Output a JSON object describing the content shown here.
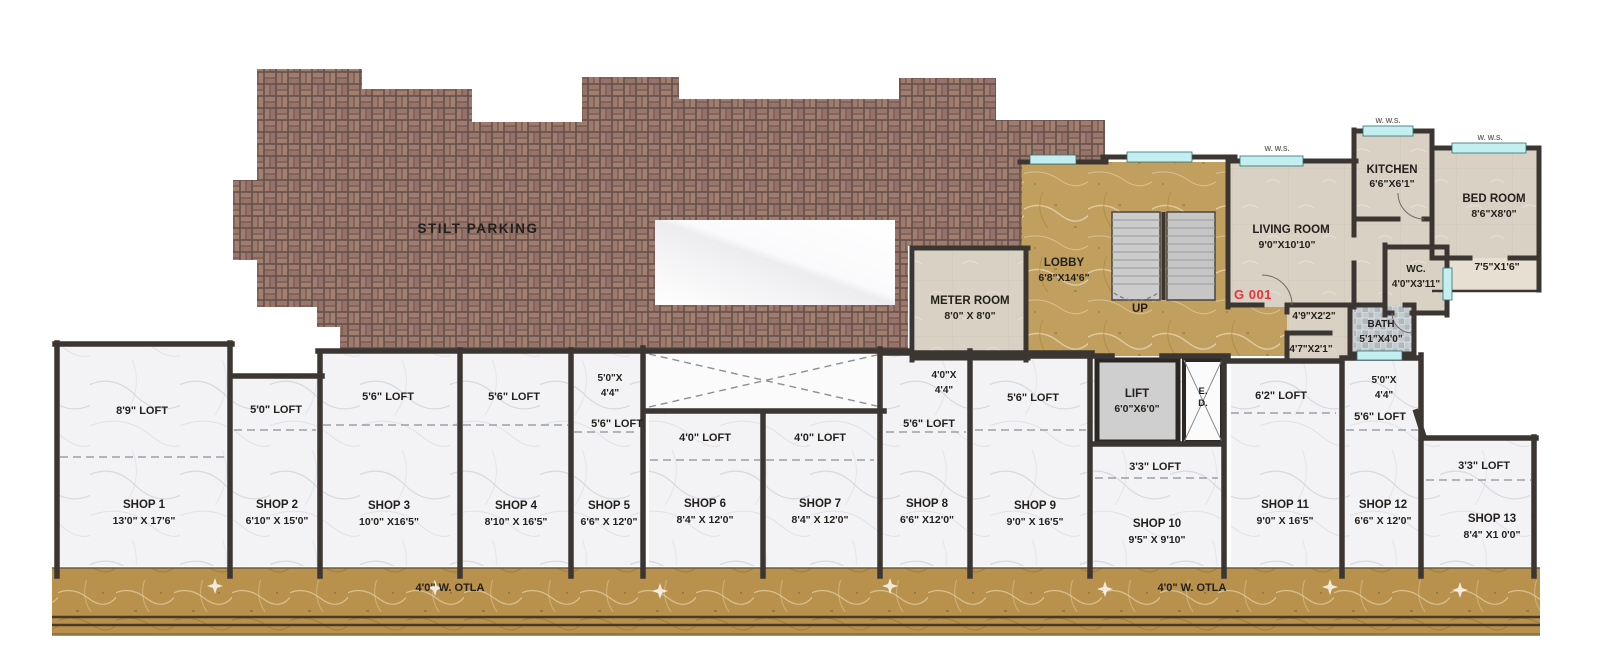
{
  "parking": {
    "label": "STILT PARKING"
  },
  "meter_room": {
    "name": "METER ROOM",
    "size": "8'0\" X 8'0\""
  },
  "lobby": {
    "name": "LOBBY",
    "size": "6'8\"X14'6\""
  },
  "staircase": {
    "up_label": "UP"
  },
  "flat": {
    "number": "G 001",
    "living_room": {
      "name": "LIVING ROOM",
      "size": "9'0\"X10'10\""
    },
    "kitchen": {
      "name": "KITCHEN",
      "size": "6'6\"X6'1\""
    },
    "bed_room": {
      "name": "BED ROOM",
      "size": "8'6\"X8'0\""
    },
    "balcony_size": "7'5\"X1'6\"",
    "wc": {
      "name": "WC.",
      "size": "4'0\"X3'11\""
    },
    "bath": {
      "name": "BATH",
      "size": "5'1\"X4'0\""
    },
    "passage_1": "4'9\"X2'2\"",
    "passage_2": "4'7\"X2'1\"",
    "window_note": "W. W.S."
  },
  "lift": {
    "name": "LIFT",
    "size": "6'0\"X6'0\""
  },
  "duct": {
    "line1": "E.",
    "line2": "D."
  },
  "shops": [
    {
      "name": "SHOP 1",
      "size": "13'0\" X 17'6\"",
      "loft": "8'9\" LOFT"
    },
    {
      "name": "SHOP 2",
      "size": "6'10\" X 15'0\"",
      "loft": "5'0\" LOFT"
    },
    {
      "name": "SHOP 3",
      "size": "10'0\" X16'5\"",
      "loft": "5'6\" LOFT"
    },
    {
      "name": "SHOP 4",
      "size": "8'10\" X 16'5\"",
      "loft": "5'6\" LOFT"
    },
    {
      "name": "SHOP 5",
      "size": "6'6\" X 12'0\"",
      "loft": "5'6\" LOFT",
      "niche_l1": "5'0\"X",
      "niche_l2": "4'4\""
    },
    {
      "name": "SHOP 6",
      "size": "8'4\" X 12'0\"",
      "loft": "4'0\" LOFT"
    },
    {
      "name": "SHOP 7",
      "size": "8'4\" X 12'0\"",
      "loft": "4'0\" LOFT"
    },
    {
      "name": "SHOP 8",
      "size": "6'6\" X12'0\"",
      "loft": "5'6\" LOFT",
      "niche_l1": "4'0\"X",
      "niche_l2": "4'4\""
    },
    {
      "name": "SHOP 9",
      "size": "9'0\" X 16'5\"",
      "loft": "5'6\" LOFT"
    },
    {
      "name": "SHOP 10",
      "size": "9'5\" X 9'10\"",
      "loft": "3'3\" LOFT"
    },
    {
      "name": "SHOP 11",
      "size": "9'0\" X 16'5\"",
      "loft": "6'2\" LOFT"
    },
    {
      "name": "SHOP 12",
      "size": "6'6\" X 12'0\"",
      "loft": "5'6\" LOFT",
      "niche_l1": "5'0\"X",
      "niche_l2": "4'4\""
    },
    {
      "name": "SHOP 13",
      "size": "8'4\" X1 0'0\"",
      "loft": "3'3\" LOFT"
    }
  ],
  "otla": {
    "left_label": "4'0\" W. OTLA",
    "right_label": "4'0\" W. OTLA"
  },
  "colors": {
    "brick": "#a07c6e",
    "grout": "#64504a",
    "gold": "#c1a05f",
    "otla_gold": "#b8924d",
    "wall": "#3c3633",
    "flat_floor": "#d9d1c3",
    "shop_floor": "#f3f3f5",
    "window": "#c4eff1",
    "flat_number_red": "#e8323c",
    "stair_gray": "#cccccc"
  }
}
